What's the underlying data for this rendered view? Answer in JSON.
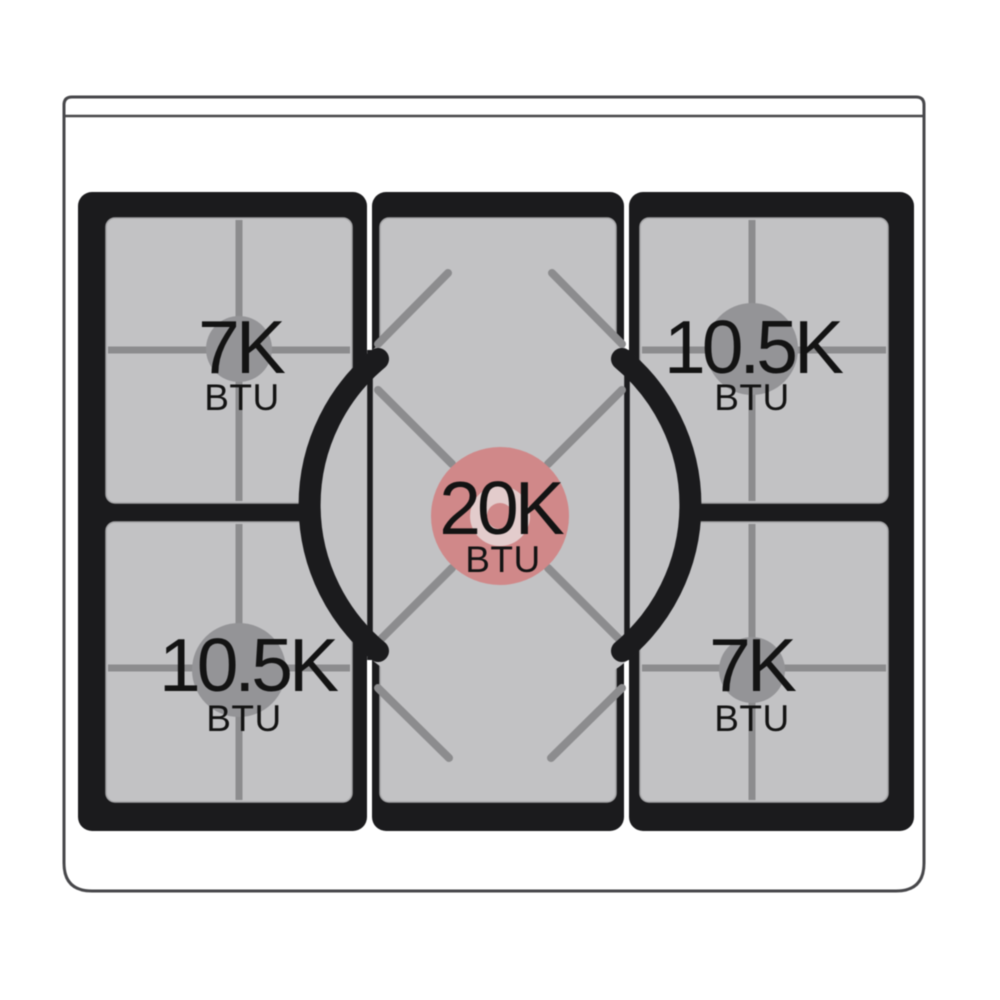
{
  "diagram": {
    "burners": {
      "top_left": {
        "power": "7K",
        "unit": "BTU"
      },
      "top_right": {
        "power": "10.5K",
        "unit": "BTU"
      },
      "center": {
        "power": "20K",
        "unit": "BTU"
      },
      "bottom_left": {
        "power": "10.5K",
        "unit": "BTU"
      },
      "bottom_right": {
        "power": "7K",
        "unit": "BTU"
      }
    },
    "colors": {
      "grate_black": "#1b1b1d",
      "panel_gray": "#c2c2c4",
      "line_gray": "#8c8c8e",
      "burner_gray": "#949497",
      "accent_pink": "#d08889",
      "accent_pink_light": "#e3cccc",
      "body_outline": "#47474a",
      "text": "#131313"
    }
  }
}
